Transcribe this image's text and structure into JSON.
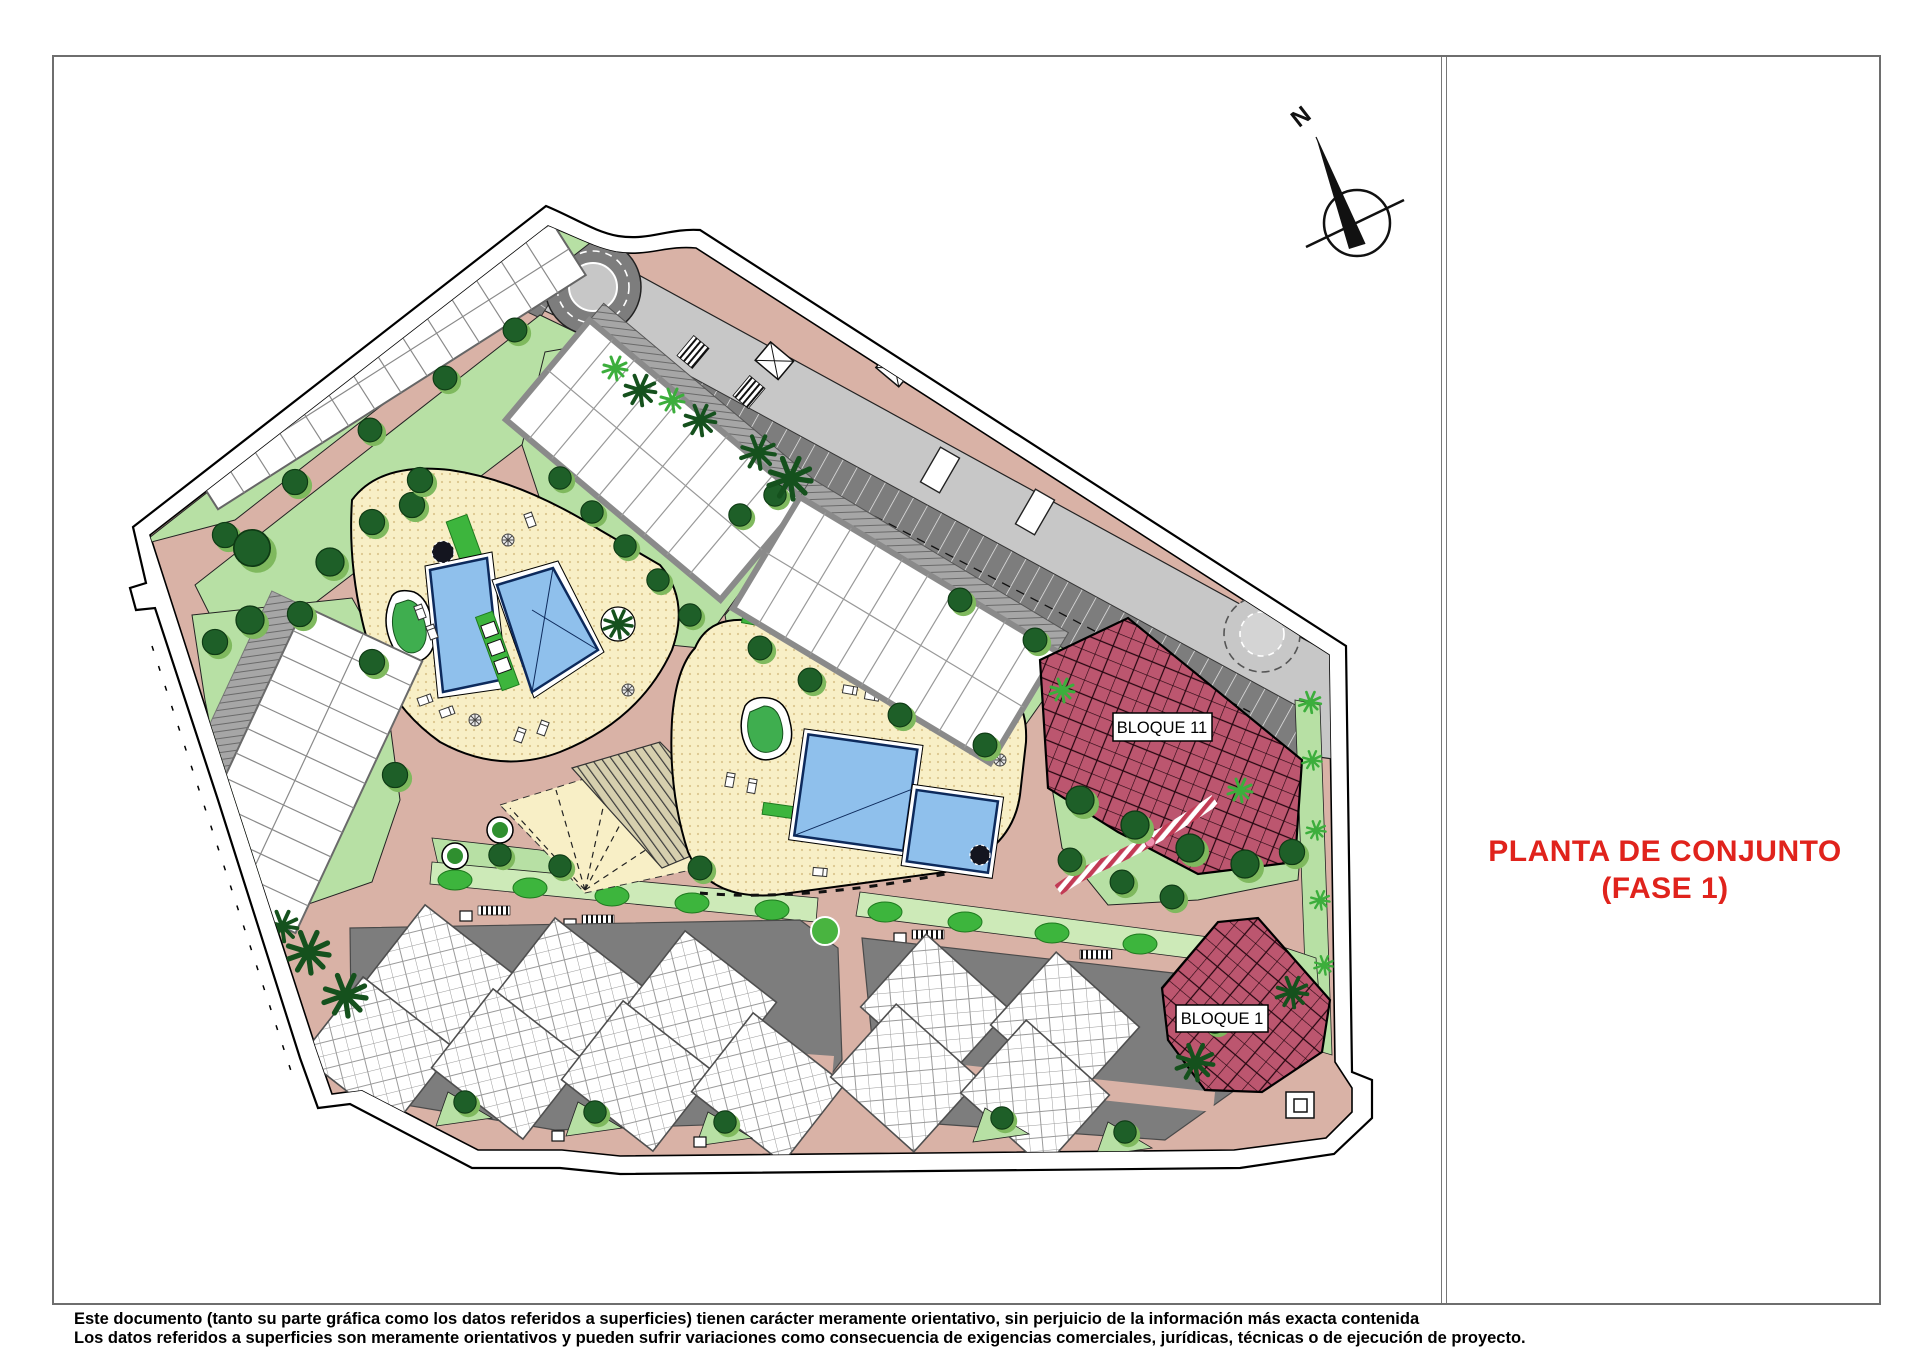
{
  "sheet": {
    "title_line1": "PLANTA DE CONJUNTO",
    "title_line2": "(FASE 1)",
    "disclaimer_line1": "Este documento (tanto su parte gráfica como los datos referidos a superficies) tienen carácter meramente orientativo, sin perjuicio de la información más exacta contenida",
    "disclaimer_line2": "Los datos referidos a superficies son meramente orientativos y pueden sufrir variaciones como consecuencia de exigencias comerciales, jurídicas, técnicas o de ejecución de proyecto."
  },
  "compass": {
    "north_label": "N"
  },
  "plan": {
    "block_labels": [
      {
        "id": "bloque-11",
        "label": "BLOQUE 11"
      },
      {
        "id": "bloque-1",
        "label": "BLOQUE 1"
      }
    ]
  },
  "palette": {
    "title_red": "#e0231c",
    "road_salmon": "#d9b2a6",
    "asphalt_light": "#c7c7c7",
    "parking_dark": "#7d7d7d",
    "green_light": "#b7e0a4",
    "green_hedge": "#3db53d",
    "tree_green": "#1e5f28",
    "deck_yellow": "#f8efc6",
    "pool_blue": "#8fc0ec",
    "pool_outline": "#0d2a5c",
    "bloque_red": "#bc566f",
    "building_white": "#ffffff",
    "building_gray": "#8a8a8a"
  }
}
